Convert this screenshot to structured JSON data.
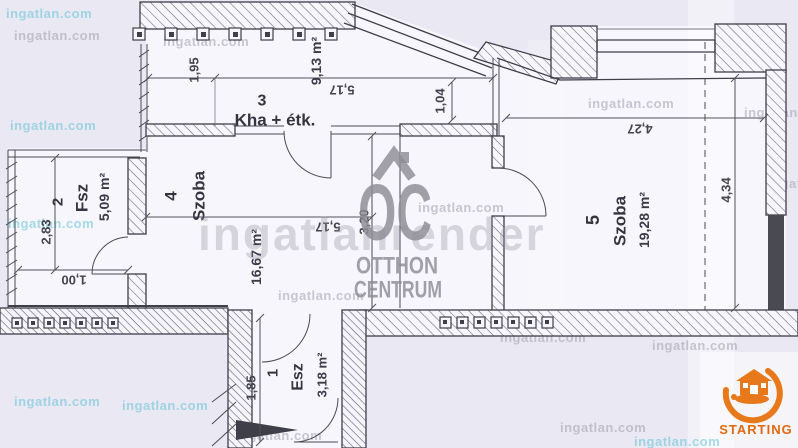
{
  "plan": {
    "rooms": {
      "r1": {
        "number": "1",
        "name": "Esz",
        "area": "3,18 m²"
      },
      "r2": {
        "number": "2",
        "name": "Fsz",
        "area": "5,09 m²"
      },
      "r3": {
        "number": "3",
        "name": "Kha + étk.",
        "area": "9,13 m²"
      },
      "r4": {
        "number": "4",
        "name": "Szoba",
        "area": "16,67 m²"
      },
      "r5": {
        "number": "5",
        "name": "Szoba",
        "area": "19,28 m²"
      }
    },
    "dims": {
      "d195": "1,95",
      "d517a": "5,17",
      "d104": "1,04",
      "d427": "4,27",
      "d434": "4,34",
      "d283": "2,83",
      "d100": "1,00",
      "d320": "3,20",
      "d517b": "5,17",
      "d185": "1,85"
    }
  },
  "watermarks": {
    "site": "ingatlan.com",
    "render": "ingatlanrender"
  },
  "logos": {
    "oc": {
      "monogram": "OC",
      "line1": "OTTHON",
      "line2": "CENTRUM"
    },
    "starting": {
      "label": "STARTING"
    }
  },
  "colors": {
    "accent_orange": "#e8791a",
    "line": "#3f3f49",
    "watermark_gray": "#9e9cac",
    "watermark_cyan": "#70c6d8"
  }
}
